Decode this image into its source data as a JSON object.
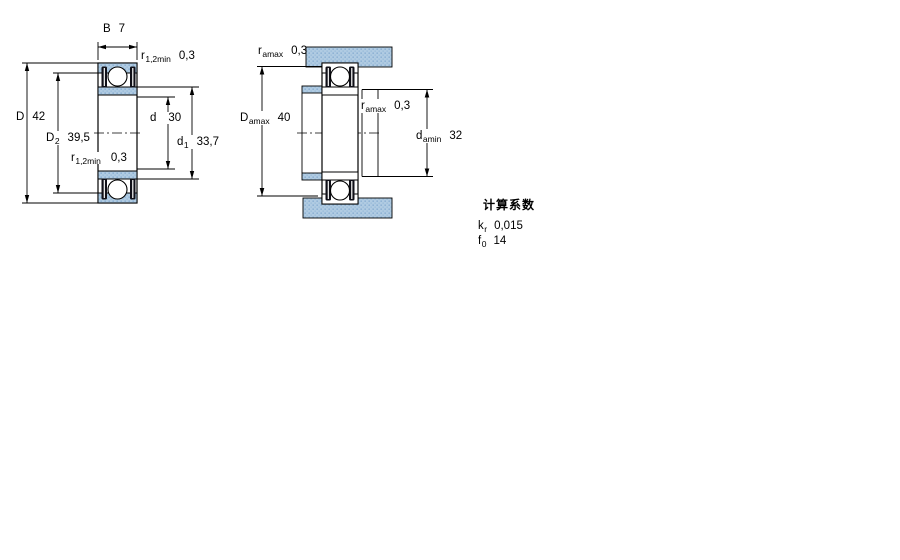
{
  "drawing": {
    "left_figure": {
      "B": {
        "sym": "B",
        "val": "7"
      },
      "r_top": {
        "sym": "r",
        "sub": "1,2min",
        "val": "0,3"
      },
      "D": {
        "sym": "D",
        "val": "42"
      },
      "D2": {
        "sym": "D",
        "sub": "2",
        "val": "39,5"
      },
      "d": {
        "sym": "d",
        "val": "30"
      },
      "d1": {
        "sym": "d",
        "sub": "1",
        "val": "33,7"
      },
      "r_bottom": {
        "sym": "r",
        "sub": "1,2min",
        "val": "0,3"
      }
    },
    "right_figure": {
      "ra_top": {
        "sym": "r",
        "sub": "amax",
        "val": "0,3"
      },
      "Da": {
        "sym": "D",
        "sub": "amax",
        "val": "40"
      },
      "ra_mid": {
        "sym": "r",
        "sub": "amax",
        "val": "0,3"
      },
      "da": {
        "sym": "d",
        "sub": "amin",
        "val": "32"
      }
    }
  },
  "calculation_factors": {
    "title": "计算系数",
    "rows": [
      {
        "sym": "k",
        "sub": "r",
        "val": "0,015"
      },
      {
        "sym": "f",
        "sub": "0",
        "val": "14"
      }
    ]
  },
  "colors": {
    "hatch_base": "#b0cbe2",
    "hatch_dot": "#8fb3d4",
    "hatch_dot2": "#9fc0dc",
    "seal": "#101018",
    "line": "#000000",
    "background": "#ffffff"
  }
}
